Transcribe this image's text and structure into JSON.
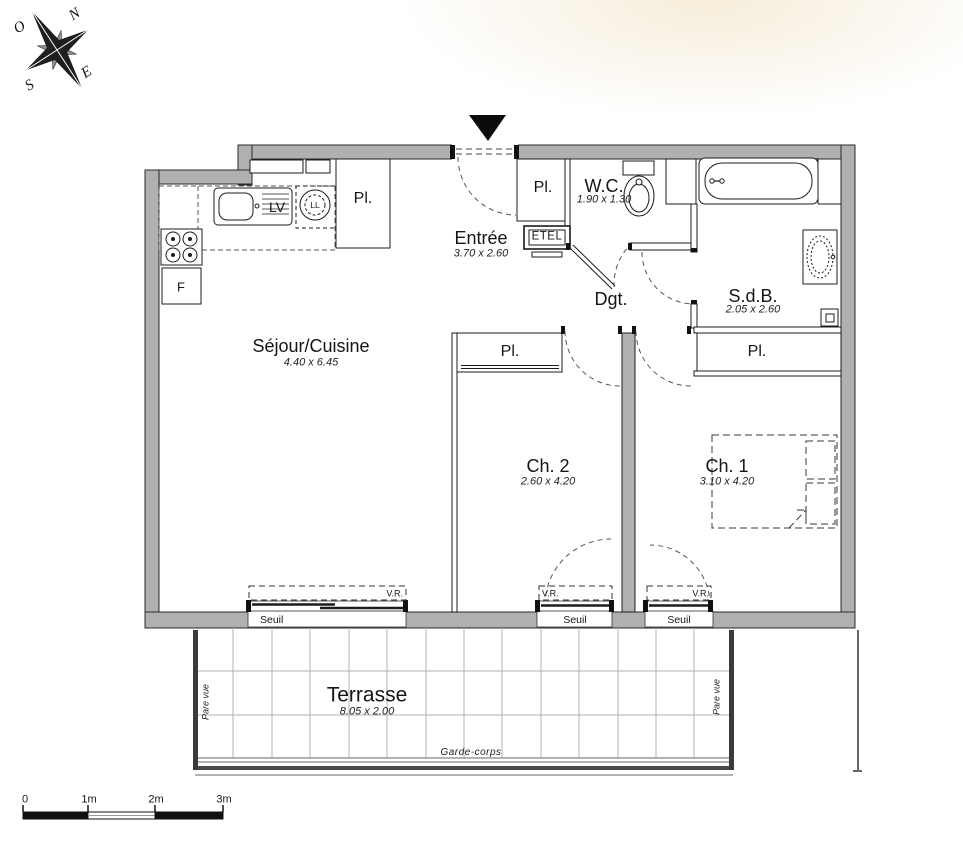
{
  "compass": {
    "north": "N",
    "west": "O",
    "east": "E",
    "south": "S"
  },
  "rooms": {
    "sejour": {
      "name": "Séjour/Cuisine",
      "dims": "4.40 x 6.45"
    },
    "entree": {
      "name": "Entrée",
      "dims": "3.70 x 2.60"
    },
    "wc": {
      "name": "W.C.",
      "dims": "1.90 x 1.30"
    },
    "sdb": {
      "name": "S.d.B.",
      "dims": "2.05 x 2.60"
    },
    "degagement": {
      "name": "Dgt."
    },
    "ch2": {
      "name": "Ch. 2",
      "dims": "2.60 x 4.20"
    },
    "ch1": {
      "name": "Ch. 1",
      "dims": "3.10 x 4.20"
    },
    "terrasse": {
      "name": "Terrasse",
      "dims": "8.05 x 2.00"
    }
  },
  "labels": {
    "closet": "Pl.",
    "dishwasher": "LV",
    "washing_machine": "LL",
    "fridge": "F",
    "technical_duct": "ETEL",
    "threshold": "Seuil",
    "rolling_shutter": "V.R.",
    "guardrail": "Garde-corps",
    "privacy_screen": "Pare vue"
  },
  "scale_bar": {
    "ticks": [
      "0",
      "1m",
      "2m",
      "3m"
    ]
  },
  "colors": {
    "wall_fill": "#b0b0b0",
    "line": "#1c1c1c",
    "grid": "#b3b3b3"
  }
}
